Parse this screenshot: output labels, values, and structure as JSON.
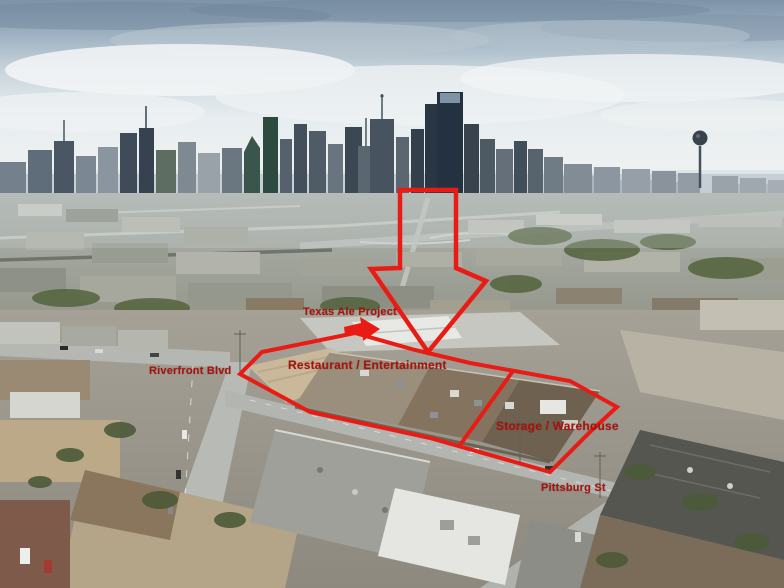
{
  "annotations": {
    "colors": {
      "line": "#e81c15",
      "text": "#a8130d"
    },
    "labels": {
      "texas_ale_project": "Texas Ale Project",
      "restaurant_entertainment": "Restaurant / Entertainment",
      "riverfront_blvd": "Riverfront Blvd",
      "storage_warehouse": "Storage / Warehouse",
      "pittsburg_st": "Pittsburg St"
    }
  }
}
